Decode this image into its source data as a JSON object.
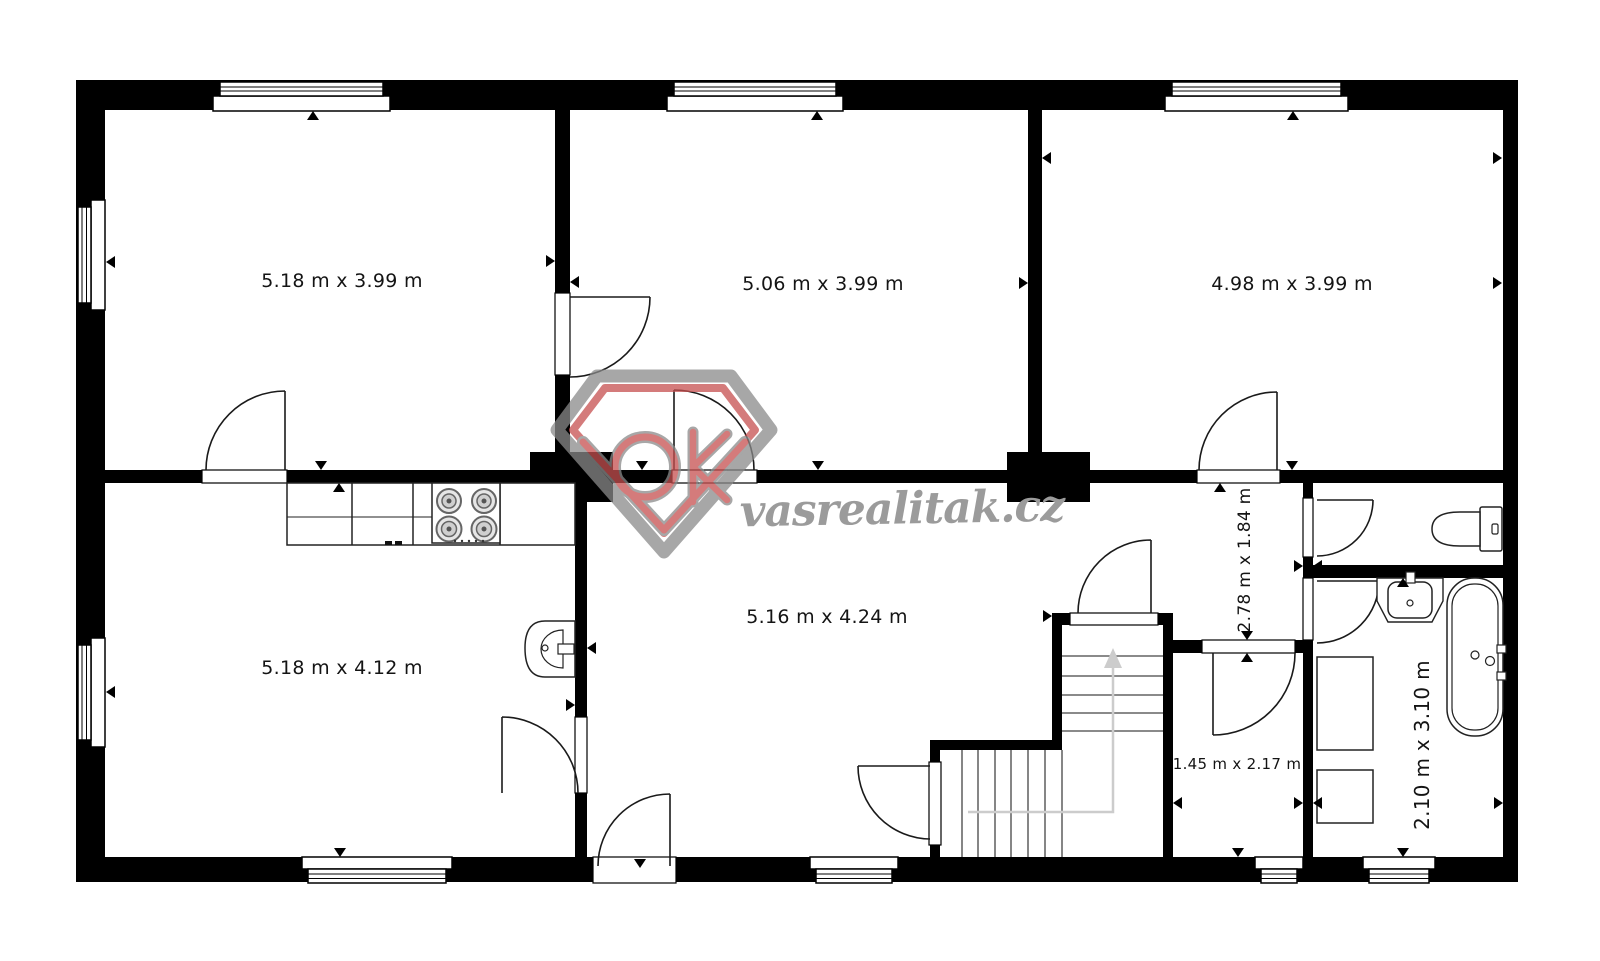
{
  "floor_plan": {
    "type": "floor-plan",
    "wall_color": "#000000",
    "background_color": "#ffffff",
    "rooms": [
      {
        "name": "room-top-left",
        "label": "5.18 m x 3.99 m",
        "rotated": false
      },
      {
        "name": "room-top-middle",
        "label": "5.06 m x 3.99 m",
        "rotated": false
      },
      {
        "name": "room-top-right",
        "label": "4.98 m x 3.99 m",
        "rotated": false
      },
      {
        "name": "room-bottom-left",
        "label": "5.18 m x 4.12 m",
        "rotated": false
      },
      {
        "name": "room-bottom-middle",
        "label": "5.16 m x 4.24 m",
        "rotated": false
      },
      {
        "name": "hallway",
        "label": "2.78 m x 1.84 m",
        "rotated": true
      },
      {
        "name": "small-room",
        "label": "1.45 m x 2.17 m",
        "rotated": false
      },
      {
        "name": "bathroom",
        "label": "2.10 m x 3.10 m",
        "rotated": true
      }
    ],
    "fixtures": [
      "kitchen-counter",
      "stove-symbol",
      "kitchen-basin-symbol",
      "toilet-symbol",
      "bathroom-sink-symbol",
      "bathtub-symbol",
      "staircase",
      "washing-machine-symbol",
      "cabinet-symbol",
      "door-arc",
      "window-symbol",
      "dimension-arrow"
    ]
  },
  "watermark": {
    "brand_text": "vasrealitak.cz",
    "logo": "ok-diamond-logo",
    "logo_red": "#c65050",
    "logo_gray": "#8a8a8a",
    "text_color": "#9b9b9b"
  }
}
